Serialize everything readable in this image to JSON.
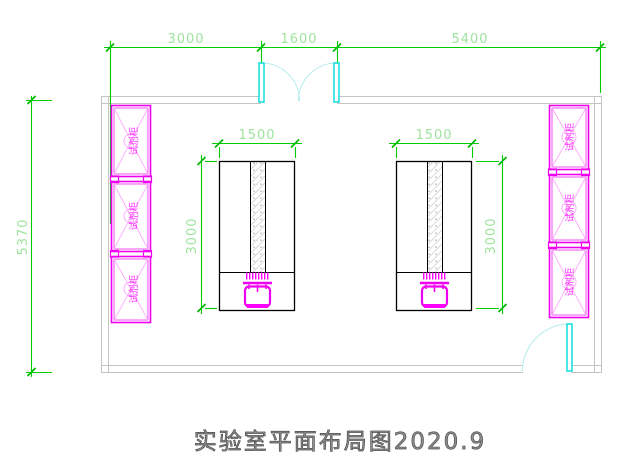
{
  "drawing": {
    "title": "实验室平面布局图2020.9",
    "type": "laboratory floor plan (CAD)"
  },
  "dimensions": {
    "top_left": "3000",
    "top_middle": "1600",
    "top_right": "5400",
    "overall_height": "5370",
    "left_bench_width": "1500",
    "left_bench_depth": "3000",
    "right_bench_width": "1500",
    "right_bench_depth": "3000"
  },
  "cabinets": {
    "left": [
      {
        "label": "试剂柜"
      },
      {
        "label": "试剂柜"
      },
      {
        "label": "试剂柜"
      }
    ],
    "right": [
      {
        "label": "试剂柜"
      },
      {
        "label": "试剂柜"
      },
      {
        "label": "试剂柜"
      }
    ]
  },
  "colors": {
    "dimension_line": "#00cc00",
    "dimension_text": "#9ee49e",
    "cabinet_magenta": "#ff00ff",
    "door_leaf_cyan": "#00dcdc",
    "door_arc": "#b2ecec",
    "wall_gray": "#c4c4c4",
    "bench_outline": "#000000",
    "title_text": "#8f8f8f"
  }
}
